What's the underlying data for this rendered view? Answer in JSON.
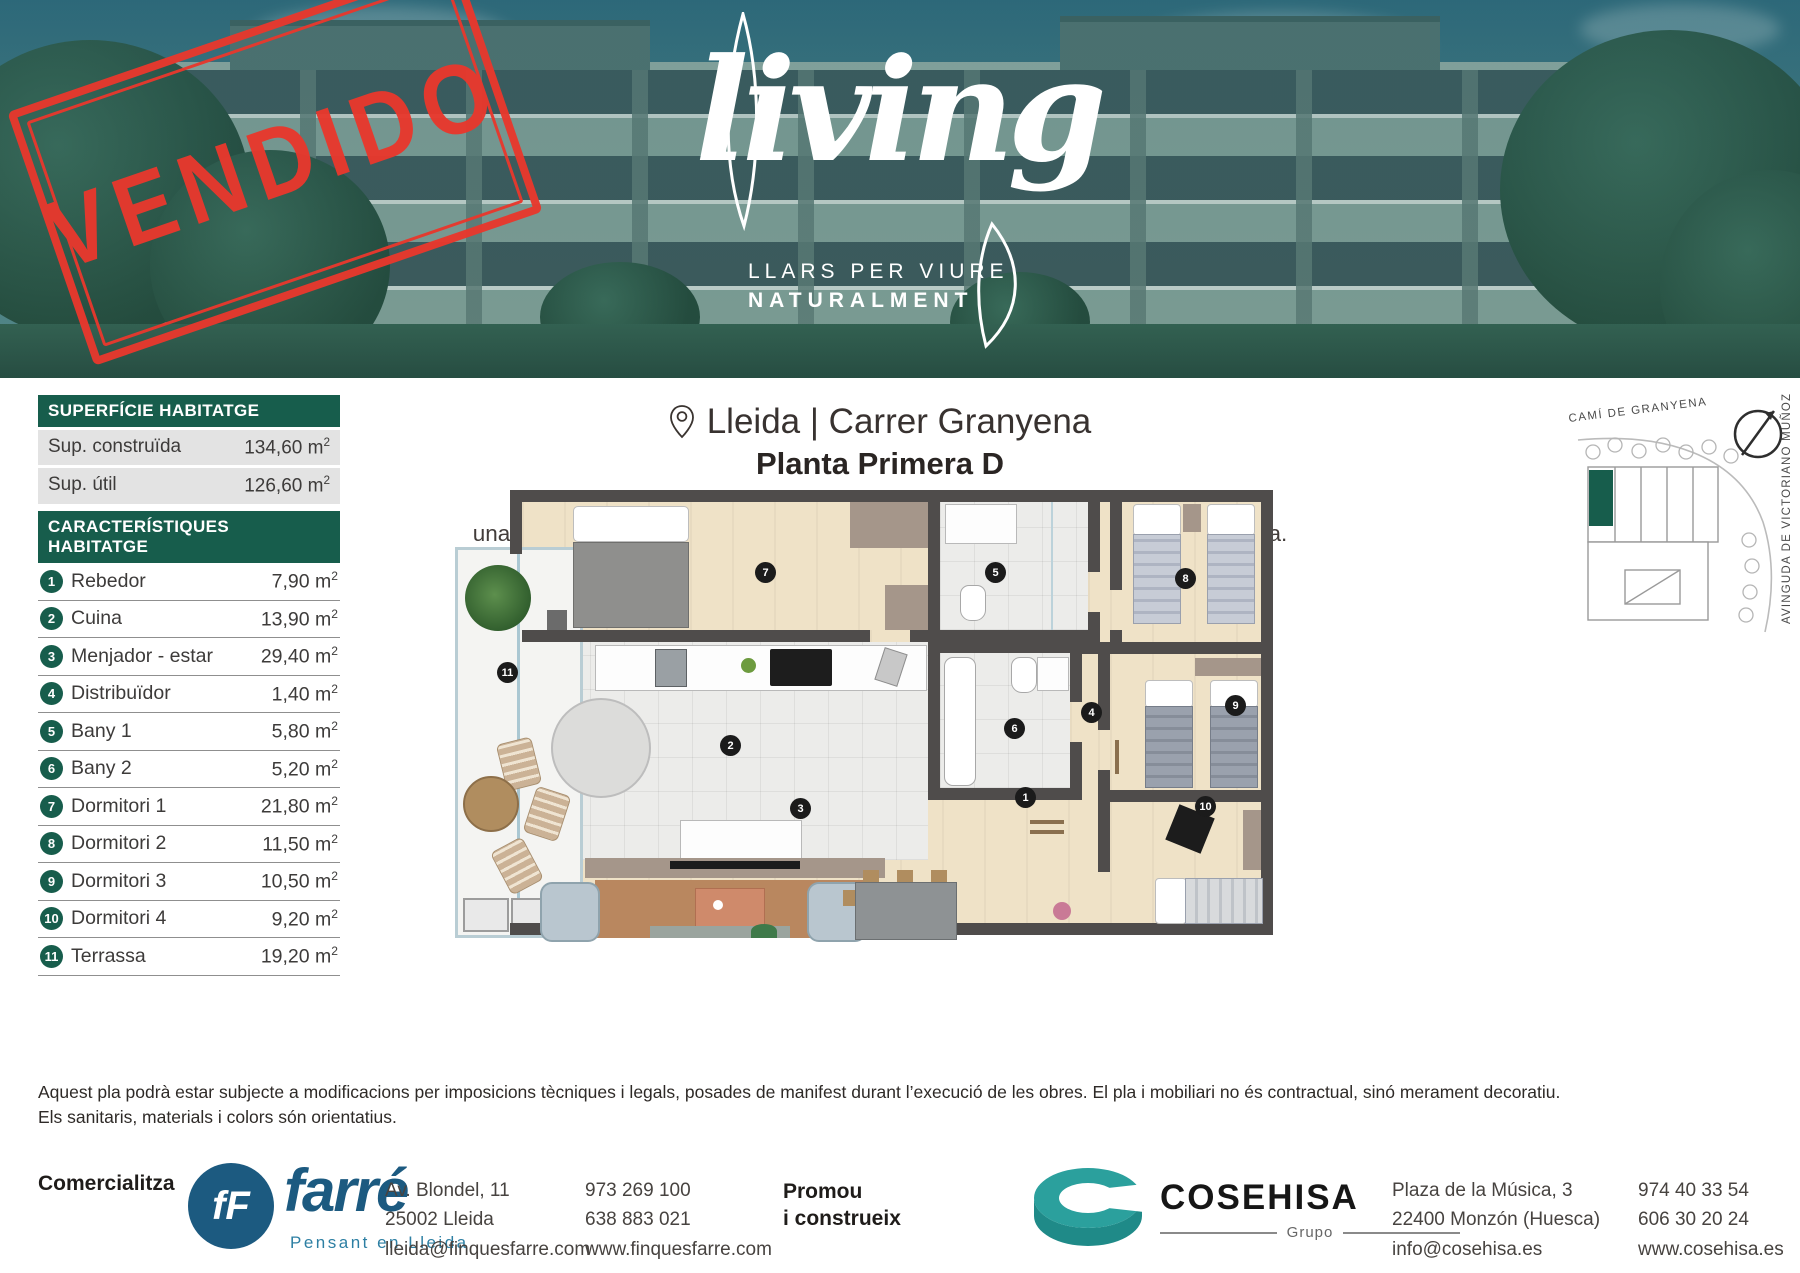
{
  "header": {
    "stamp": "VENDIDO",
    "logo_script": "living",
    "logo_tagline1": "LLARS PER VIURE",
    "logo_tagline2": "NATURALMENT"
  },
  "surface": {
    "title": "SUPERFÍCIE HABITATGE",
    "rows": [
      {
        "label": "Sup. construïda",
        "value": "134,60 m",
        "exp": "2"
      },
      {
        "label": "Sup. útil",
        "value": "126,60 m",
        "exp": "2"
      }
    ]
  },
  "features": {
    "title": "CARACTERÍSTIQUES HABITATGE",
    "items": [
      {
        "num": "1",
        "label": "Rebedor",
        "value": "7,90 m",
        "exp": "2"
      },
      {
        "num": "2",
        "label": "Cuina",
        "value": "13,90 m",
        "exp": "2"
      },
      {
        "num": "3",
        "label": "Menjador - estar",
        "value": "29,40 m",
        "exp": "2"
      },
      {
        "num": "4",
        "label": "Distribuïdor",
        "value": "1,40 m",
        "exp": "2"
      },
      {
        "num": "5",
        "label": "Bany 1",
        "value": "5,80 m",
        "exp": "2"
      },
      {
        "num": "6",
        "label": "Bany 2",
        "value": "5,20 m",
        "exp": "2"
      },
      {
        "num": "7",
        "label": "Dormitori 1",
        "value": "21,80 m",
        "exp": "2"
      },
      {
        "num": "8",
        "label": "Dormitori 2",
        "value": "11,50 m",
        "exp": "2"
      },
      {
        "num": "9",
        "label": "Dormitori 3",
        "value": "10,50 m",
        "exp": "2"
      },
      {
        "num": "10",
        "label": "Dormitori 4",
        "value": "9,20 m",
        "exp": "2"
      },
      {
        "num": "11",
        "label": "Terrassa",
        "value": "19,20 m",
        "exp": "2"
      }
    ]
  },
  "location": {
    "title": "Lleida | Carrer Granyena",
    "subtitle": "Planta Primera D",
    "desc_line1": "Living és una promoció d’obra nova. Habitatge de 4 dormitoris, amb",
    "desc_line2_a": "una superfície construïda de 134,60 m",
    "desc_line2_exp": "2",
    "desc_line2_b": " i una magnífica zona comunitària privada."
  },
  "sitemap": {
    "street_top": "CAMÍ DE GRANYENA",
    "street_right": "AVINGUDA DE VICTORIANO MUÑOZ"
  },
  "floorplan": {
    "markers": [
      "1",
      "2",
      "3",
      "4",
      "5",
      "6",
      "7",
      "8",
      "9",
      "10",
      "11"
    ]
  },
  "disclaimer": {
    "line1": "Aquest pla podrà estar subjecte a modificacions per imposicions tècniques i legals, posades de manifest durant l’execució de les obres. El pla i mobiliari no és contractual, sinó merament decoratiu.",
    "line2": "Els sanitaris, materials i colors són orientatius."
  },
  "footer": {
    "commercial_label": "Comercialitza",
    "farre_monogram": "fF",
    "farre_name": "farré",
    "farre_tagline": "Pensant en Lleida",
    "farre_address": [
      "Av. Blondel, 11",
      "25002 Lleida",
      "lleida@finquesfarre.com"
    ],
    "farre_contact": [
      "973 269 100",
      "638 883 021",
      "www.finquesfarre.com"
    ],
    "promoter_line1": "Promou",
    "promoter_line2": "i construeix",
    "cosehisa_name": "COSEHISA",
    "cosehisa_group": "Grupo",
    "cosehisa_address": [
      "Plaza de la Música, 3",
      "22400 Monzón (Huesca)",
      "info@cosehisa.es"
    ],
    "cosehisa_contact": [
      "974 40 33 54",
      "606 30 20 24",
      "www.cosehisa.es"
    ]
  },
  "colors": {
    "brand_green": "#175d4c",
    "stamp_red": "#e8382d",
    "farre_blue": "#1c5a80",
    "farre_teal": "#2d7fa3",
    "cosehisa_teal": "#2ba09d"
  }
}
